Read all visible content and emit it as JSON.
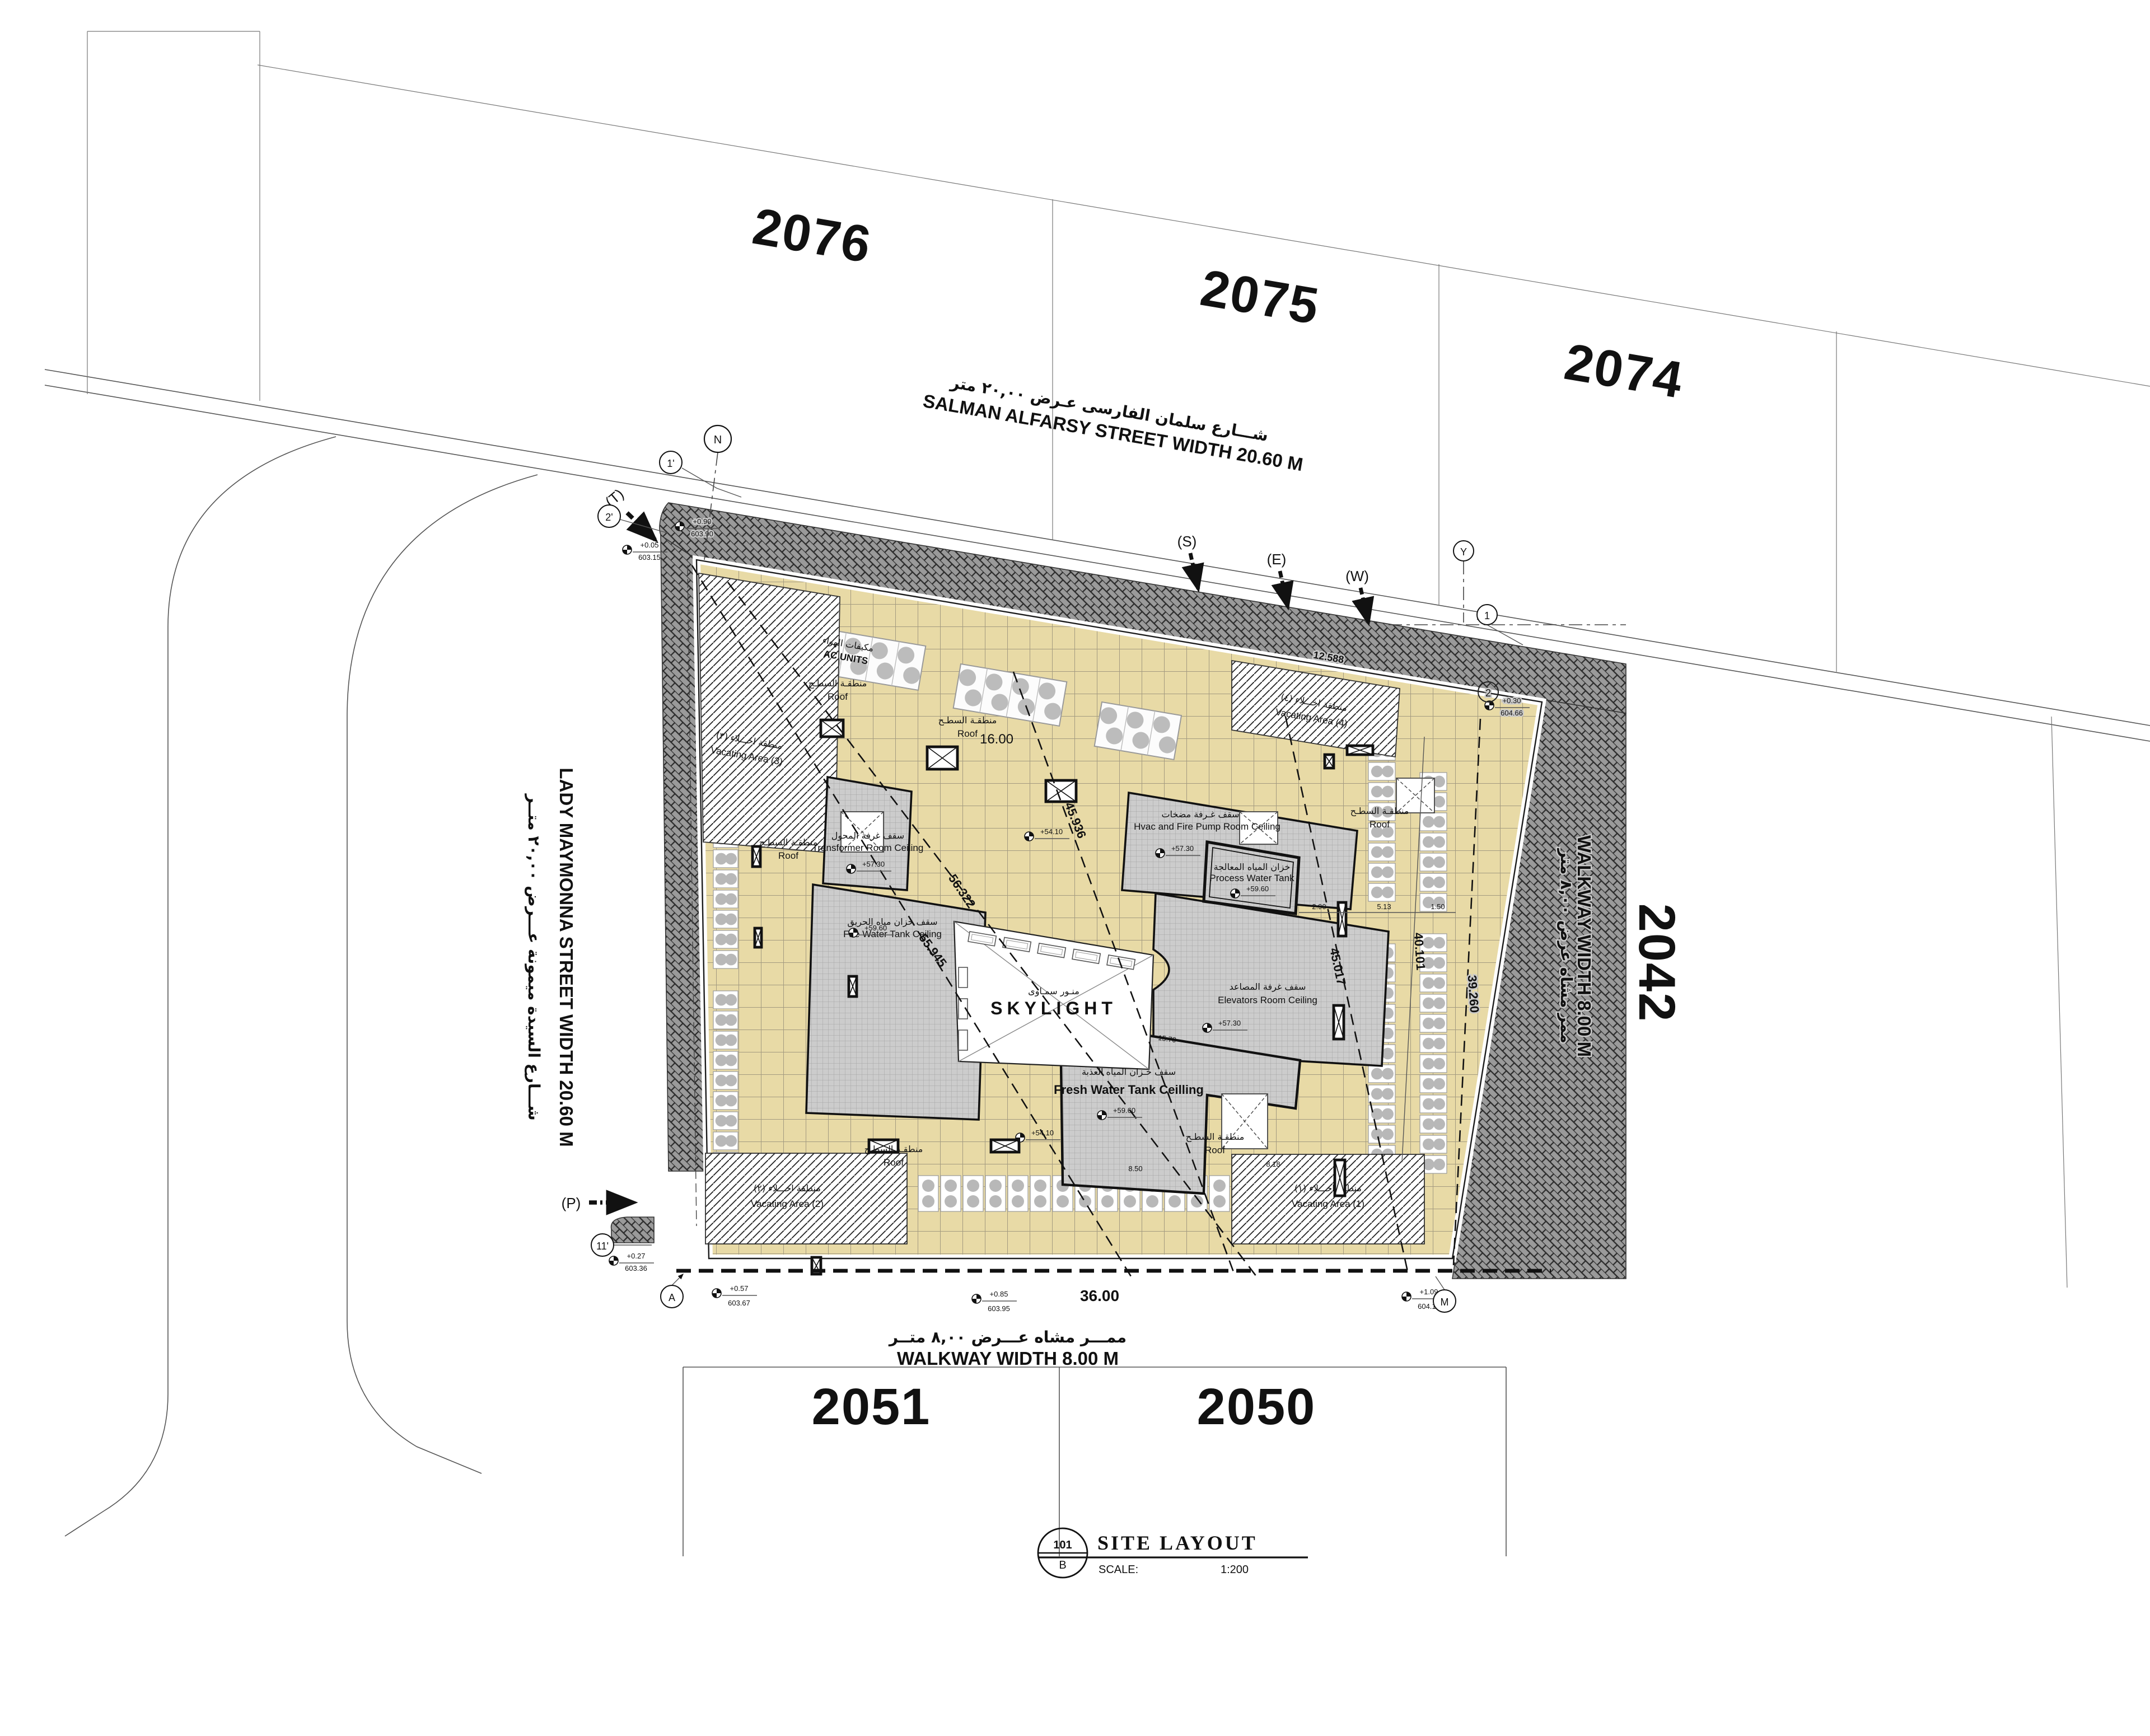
{
  "plots": {
    "p2076": "2076",
    "p2075": "2075",
    "p2074": "2074",
    "p2042": "2042",
    "p2051": "2051",
    "p2050": "2050"
  },
  "streets": {
    "salman_ar": "شـــارع سلمان الفارسى عـرض ٢٠,٠٠ متر",
    "salman_en": "SALMAN ALFARSY STREET WIDTH 20.60 M",
    "maymonna_ar": "شـــارع السيدة ميمونة عـــرض ٢٠,٠٠ متــر",
    "maymonna_en": "LADY MAYMONNA STREET WIDTH 20.60 M",
    "walkway_bottom_ar": "ممـــر مشاه عـــرض ٨,٠٠ متــر",
    "walkway_bottom_en": "WALKWAY WIDTH 8.00 M",
    "walkway_right_ar": "ممر مشاه عرض ٨,٠٠ متر",
    "walkway_right_en": "WALKWAY WIDTH 8.00 M"
  },
  "labels": {
    "skylight_ar": "منـور سمـاوى",
    "skylight_en": "SKYLIGHT",
    "ac_ar": "مكيفات الهواء",
    "ac_en": "AC UNITS",
    "roof_ar": "منطقـة السطـح",
    "roof_en": "Roof",
    "transformer_ar": "سقف غرفة المحول",
    "transformer_en": "Transformer Room Ceiling",
    "firewater_ar": "سقف خزان مياه الحريق",
    "firewater_en": "Fire Water Tank Ceiling",
    "hvac_ar": "سقف غـرفة مضخات",
    "hvac_en": "Hvac and Fire Pump Room Ceiling",
    "process_ar": "خزان المياه المعالجة",
    "process_en": "Process Water Tank",
    "elevators_ar": "سقف غرفة المصاعد",
    "elevators_en": "Elevators Room Ceiling",
    "freshwater_ar": "سقف خـزان المياه العذبة",
    "freshwater_en": "Fresh Water Tank Ceilling",
    "vac1_ar": "منطقة اخـــلاء (١)",
    "vac1_en": "Vacating Area (1)",
    "vac2_ar": "منطقة اخـــلاء (٢)",
    "vac2_en": "Vacating Area (2)",
    "vac3_ar": "منطقة اخـــلاء (٣)",
    "vac3_en": "Vacating Area (3)",
    "vac4_ar": "منطقة اخـــلاء (٤)",
    "vac4_en": "Vacating Area (4)"
  },
  "levels": {
    "transformer": "+57.30",
    "firewater": "+59.60",
    "hvac": "+57.30",
    "process": "+59.60",
    "elevators": "+57.30",
    "freshwater": "+59.60",
    "roofA": "+54.10",
    "roofB": "+54.10"
  },
  "spots": [
    {
      "v": "+0.05",
      "d": "603.15"
    },
    {
      "v": "+0.90",
      "d": "603.90"
    },
    {
      "v": "+0.30",
      "d": "604.66"
    },
    {
      "v": "+0.27",
      "d": "603.36"
    },
    {
      "v": "+0.57",
      "d": "603.67"
    },
    {
      "v": "+0.85",
      "d": "603.95"
    },
    {
      "v": "+1.09",
      "d": "604.19"
    }
  ],
  "dims": {
    "k16": "16.00",
    "k36": "36.00",
    "k12588": "12.588",
    "k56322": "56.322",
    "k55945": "55.945",
    "k45936": "45.936",
    "k45017": "45.017",
    "k40101": "40.101",
    "k39260": "39.260",
    "k1570": "15.70",
    "k850": "8.50",
    "k818": "8.18",
    "k290": "2.90",
    "k513": "5.13",
    "k150": "1.50"
  },
  "markers": {
    "s": "(S)",
    "e": "(E)",
    "w": "(W)",
    "p": "(P)",
    "t": "(T)"
  },
  "bubbles": {
    "n": "N",
    "y": "Y",
    "g1": "1",
    "g2": "2",
    "g1p": "1'",
    "g2p": "2'",
    "g11p": "11'",
    "a": "A",
    "m": "M"
  },
  "title_block": {
    "number": "101",
    "revision": "B",
    "title": "SITE  LAYOUT",
    "scale_label": "SCALE:",
    "scale_value": "1:200"
  }
}
